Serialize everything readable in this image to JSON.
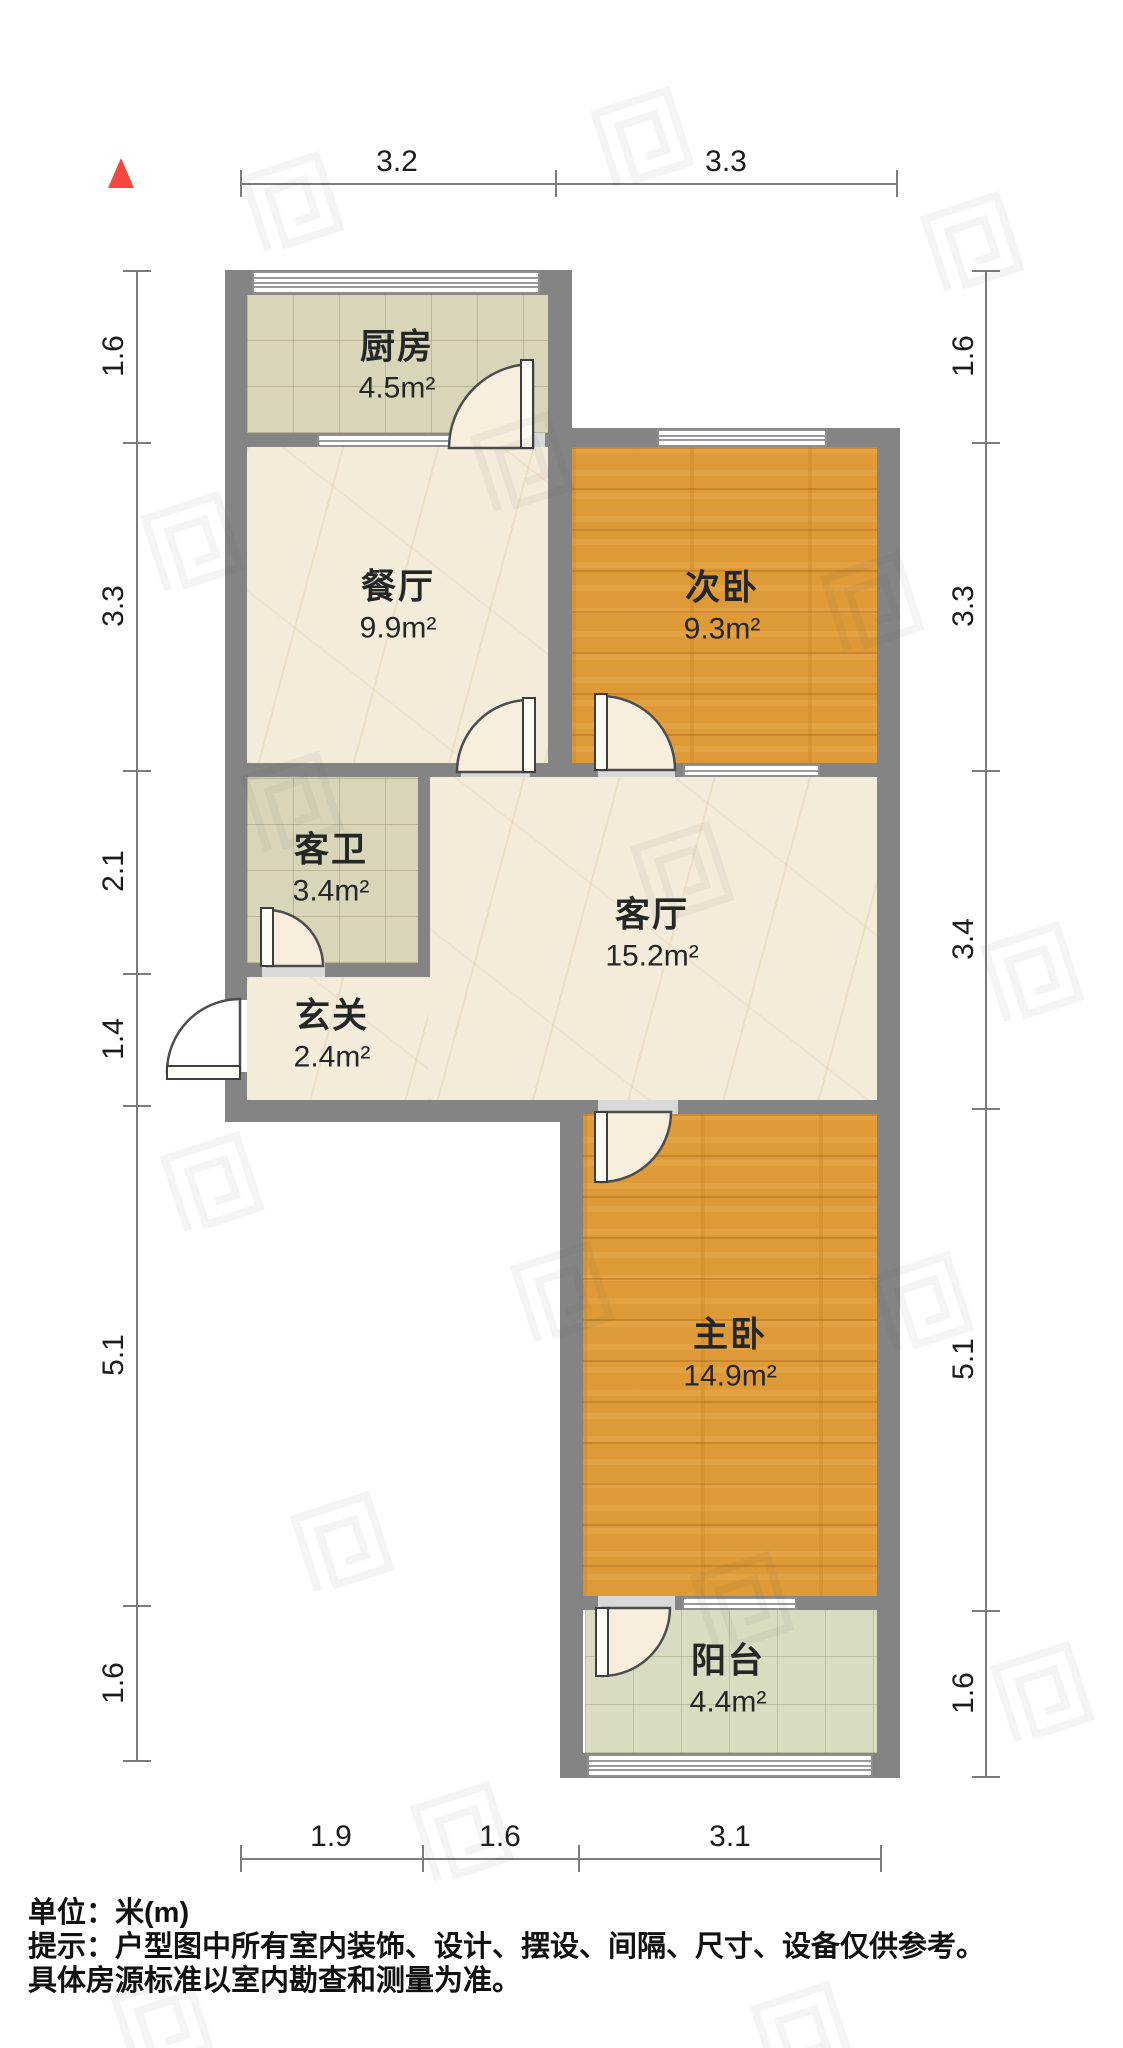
{
  "compass": {
    "direction": "north",
    "color": "#f4473f"
  },
  "rooms": {
    "kitchen": {
      "name": "厨房",
      "area": "4.5m²"
    },
    "dining": {
      "name": "餐厅",
      "area": "9.9m²"
    },
    "bedroom2": {
      "name": "次卧",
      "area": "9.3m²"
    },
    "bath": {
      "name": "客卫",
      "area": "3.4m²"
    },
    "foyer": {
      "name": "玄关",
      "area": "2.4m²"
    },
    "living": {
      "name": "客厅",
      "area": "15.2m²"
    },
    "master": {
      "name": "主卧",
      "area": "14.9m²"
    },
    "balcony": {
      "name": "阳台",
      "area": "4.4m²"
    }
  },
  "dimensions": {
    "top": [
      "3.2",
      "3.3"
    ],
    "bottom": [
      "1.9",
      "1.6",
      "3.1"
    ],
    "left": [
      "1.6",
      "3.3",
      "2.1",
      "1.4",
      "5.1",
      "1.6"
    ],
    "right": [
      "1.6",
      "3.3",
      "3.4",
      "5.1",
      "1.6"
    ]
  },
  "notes": {
    "unit": "单位：米(m)",
    "tip1": "提示：户型图中所有室内装饰、设计、摆设、间隔、尺寸、设备仅供参考。",
    "tip2": "具体房源标准以室内勘查和测量为准。"
  },
  "colors": {
    "wall": "#848484",
    "wood_floor": "#dd9a37",
    "marble_floor": "#f3ecdb",
    "tile_floor": "#d8d5b9",
    "balcony_floor": "#d9dcc1",
    "north_red": "#f4473f"
  }
}
